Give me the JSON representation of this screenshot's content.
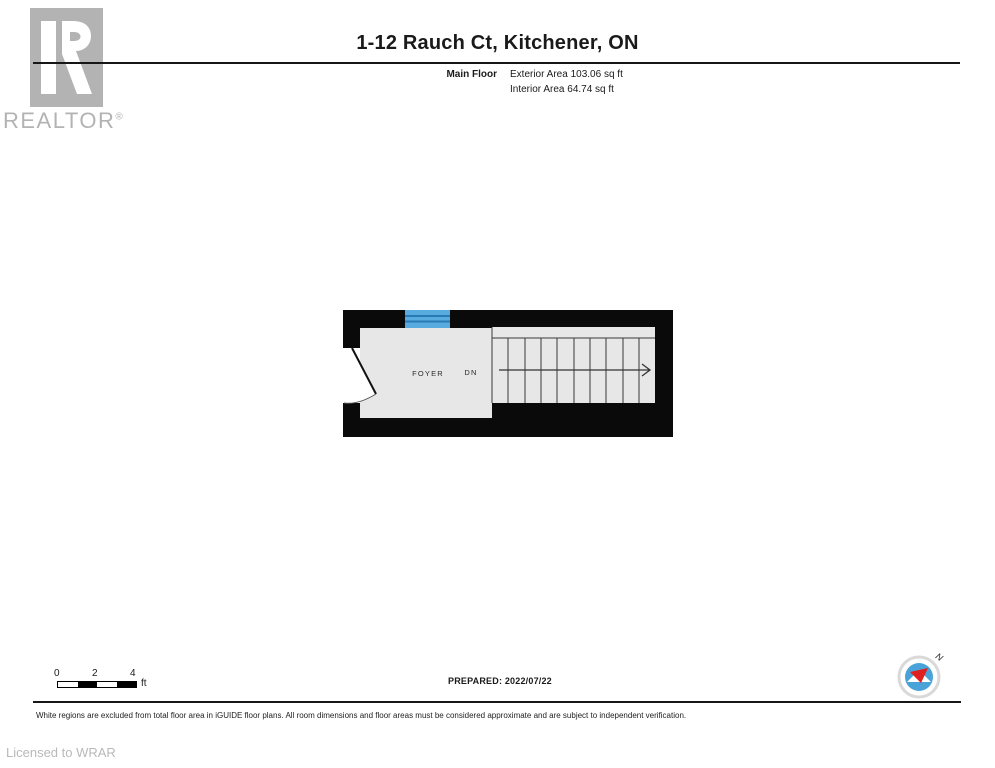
{
  "header": {
    "title": "1-12 Rauch Ct, Kitchener, ON",
    "floor_name": "Main Floor",
    "exterior_area": "Exterior Area 103.06 sq ft",
    "interior_area": "Interior Area 64.74 sq ft"
  },
  "logo": {
    "brand": "REALTOR",
    "registered": "®"
  },
  "plan": {
    "room_label": "FOYER",
    "stairs_label": "DN",
    "colors": {
      "wall": "#0a0a0a",
      "floor": "#e7e7e7",
      "window": "#58abdf",
      "window_mullion": "#2878b4",
      "excluded_region": "#ffffff",
      "stair_line": "#3a3a3a"
    }
  },
  "scale_bar": {
    "ticks": [
      "0",
      "2",
      "4"
    ],
    "unit": "ft"
  },
  "compass": {
    "north_label": "N",
    "colors": {
      "ring": "#d9d9d9",
      "face": "#4aa3d8",
      "needle_red": "#e01f1f"
    }
  },
  "footer": {
    "prepared": "PREPARED: 2022/07/22",
    "disclaimer": "White regions are excluded from total floor area in iGUIDE floor plans. All room dimensions and floor areas must be considered approximate and are subject to independent verification.",
    "licensed": "Licensed to WRAR"
  }
}
